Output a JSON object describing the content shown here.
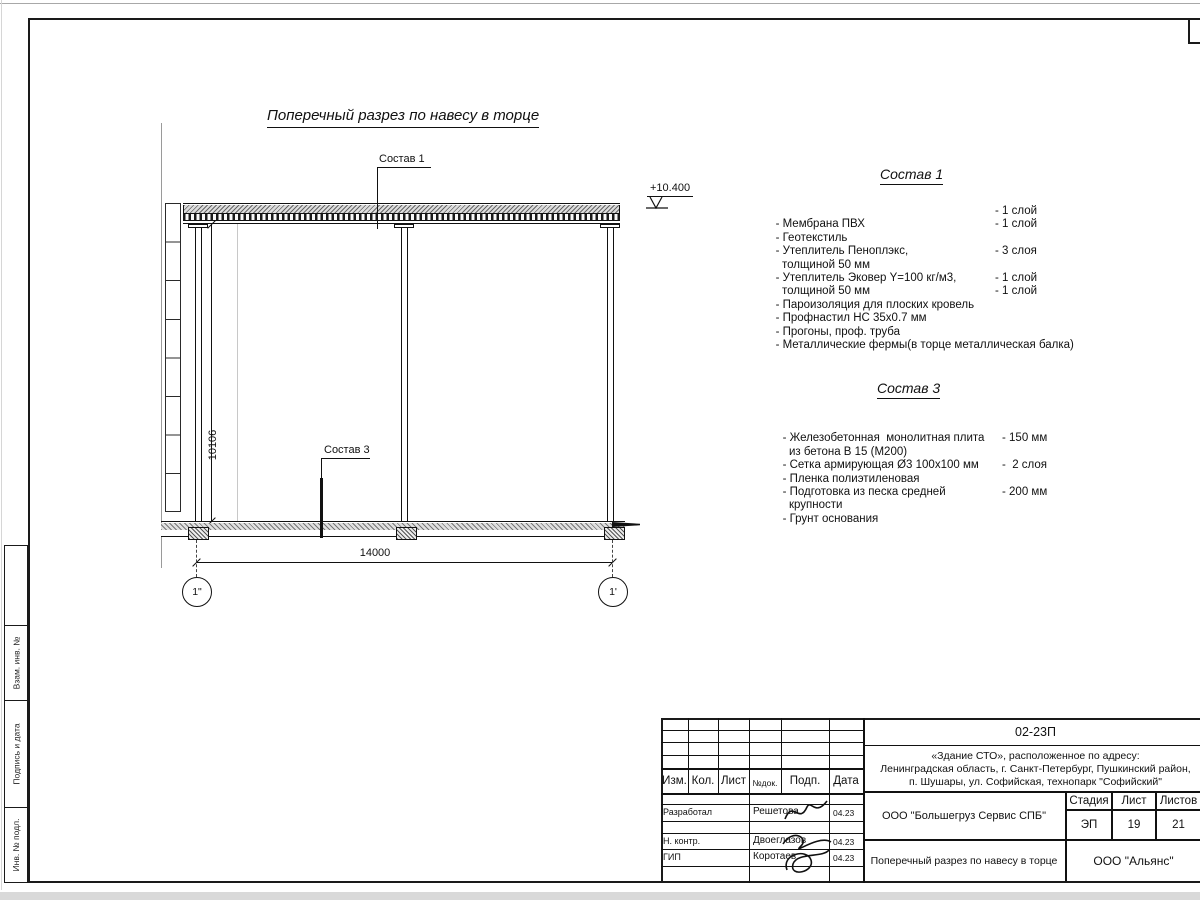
{
  "drawing": {
    "title": "Поперечный разрез по навесу в торце",
    "elevation_mark": "+10.400",
    "dim_vertical": "10106",
    "dim_horizontal": "14000",
    "axis_left": "1\"",
    "axis_right": "1'",
    "leader1_label": "Состав 1",
    "leader3_label": "Состав 3"
  },
  "sostav1": {
    "heading": "Состав 1",
    "items": [
      {
        "name": "- Мембрана ПВХ",
        "qty": "- 1 слой"
      },
      {
        "name": "- Геотекстиль",
        "qty": "- 1 слой"
      },
      {
        "name": "- Утеплитель Пеноплэкс,",
        "qty": ""
      },
      {
        "name": "  толщиной 50 мм",
        "qty": "- 3 слоя"
      },
      {
        "name": "- Утеплитель Эковер Y=100 кг/м3,",
        "qty": ""
      },
      {
        "name": "  толщиной 50 мм",
        "qty": "- 1 слой"
      },
      {
        "name": "- Пароизоляция для плоских кровель",
        "qty": "- 1 слой"
      },
      {
        "name": "- Профнастил НС 35х0.7 мм",
        "qty": ""
      },
      {
        "name": "- Прогоны, проф. труба",
        "qty": ""
      },
      {
        "name": "- Металлические фермы(в торце металлическая балка)",
        "qty": ""
      }
    ]
  },
  "sostav3": {
    "heading": "Состав 3",
    "items": [
      {
        "name": "- Железобетонная  монолитная плита",
        "qty": ""
      },
      {
        "name": "  из бетона В 15 (М200)",
        "qty": "- 150 мм"
      },
      {
        "name": "- Сетка армирующая Ø3 100x100 мм",
        "qty": ""
      },
      {
        "name": "- Пленка полиэтиленовая",
        "qty": "-  2 слоя"
      },
      {
        "name": "- Подготовка из песка средней",
        "qty": ""
      },
      {
        "name": "  крупности",
        "qty": "- 200 мм"
      },
      {
        "name": "- Грунт основания",
        "qty": ""
      }
    ]
  },
  "margin_labels": [
    "Взам. инв. №",
    "Подпись и дата",
    "Инв. № подл."
  ],
  "title_block": {
    "doc_number": "02-23П",
    "address_lines": [
      "«Здание СТО», расположенное по адресу:",
      "Ленинградская область, г. Санкт-Петербург, Пушкинский район,",
      "п. Шушары, ул. Софийская, технопарк \"Софийский\""
    ],
    "header_cells": [
      "Изм.",
      "Кол.",
      "Лист",
      "№док.",
      "Подп.",
      "Дата"
    ],
    "rows": [
      {
        "role": "Разработал",
        "name": "Решетова",
        "date": "04.23"
      },
      {
        "role": "Н. контр.",
        "name": "Двоеглазов",
        "date": "04.23"
      },
      {
        "role": "ГИП",
        "name": "Коротаев",
        "date": "04.23"
      }
    ],
    "company": "ООО \"Большегруз Сервис СПБ\"",
    "stage_header": [
      "Стадия",
      "Лист",
      "Листов"
    ],
    "stage_values": [
      "ЭП",
      "19",
      "21"
    ],
    "sheet_title": "Поперечный разрез по навесу в торце",
    "org": "ООО \"Альянс\""
  }
}
